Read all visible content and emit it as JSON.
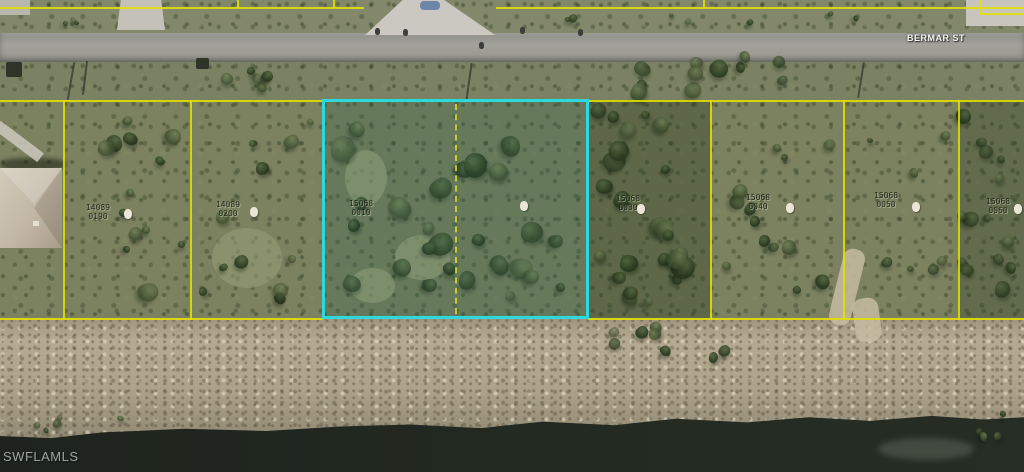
{
  "scene": {
    "street_label": "BERMAR ST",
    "watermark": "SWFLAMLS"
  },
  "colors": {
    "parcel_boundary": "#e3df00",
    "highlight": "#2bd9df"
  },
  "parcels": [
    {
      "block": "14089",
      "lot": "0190",
      "highlighted": false
    },
    {
      "block": "14089",
      "lot": "0200",
      "highlighted": false
    },
    {
      "block": "15068",
      "lot": "0010",
      "highlighted": true
    },
    {
      "block": "15068",
      "lot": "0030",
      "highlighted": false
    },
    {
      "block": "15068",
      "lot": "0040",
      "highlighted": false
    },
    {
      "block": "15068",
      "lot": "0050",
      "highlighted": false
    },
    {
      "block": "15068",
      "lot": "0060",
      "highlighted": false
    }
  ]
}
